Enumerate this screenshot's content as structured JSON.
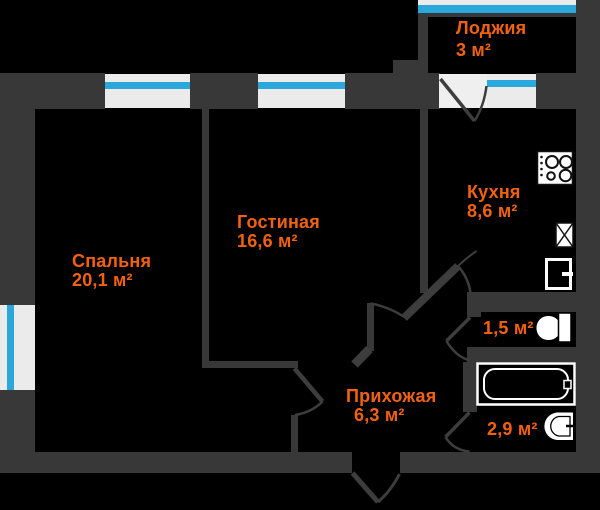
{
  "plan": {
    "title": "Apartment floor plan",
    "colors": {
      "background": "#000000",
      "wall": "#383838",
      "label_accent": "#f2620e",
      "window_glass": "#2aa7db",
      "window_frame": "#ebebeb",
      "fixture": "#ffffff"
    },
    "rooms": [
      {
        "id": "loggia",
        "name": "Лоджия",
        "area": "3 м²"
      },
      {
        "id": "kitchen",
        "name": "Кухня",
        "area": "8,6 м²"
      },
      {
        "id": "living",
        "name": "Гостиная",
        "area": "16,6 м²"
      },
      {
        "id": "bedroom",
        "name": "Спальня",
        "area": "20,1 м²"
      },
      {
        "id": "hall",
        "name": "Прихожая",
        "area": "6,3 м²"
      },
      {
        "id": "wc",
        "name": "",
        "area": "1,5 м²"
      },
      {
        "id": "bath",
        "name": "",
        "area": "2,9 м²"
      }
    ],
    "fixtures": [
      "stove-icon",
      "sink-icon",
      "fridge-icon",
      "toilet-icon",
      "bathtub-icon",
      "washbasin-icon"
    ],
    "openings": [
      "balcony-door",
      "kitchen-door",
      "living-door",
      "bedroom-door",
      "wc-door",
      "bath-door",
      "entrance-door"
    ]
  }
}
